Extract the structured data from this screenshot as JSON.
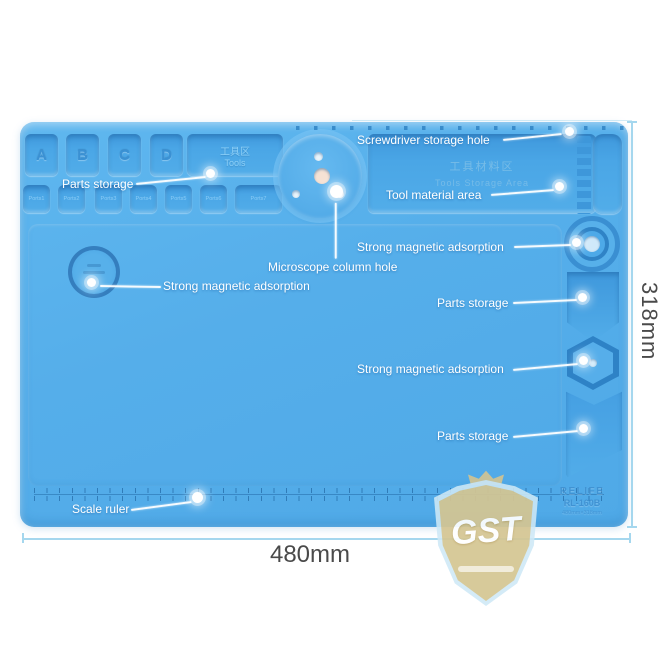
{
  "product": {
    "brand_line1": "RELIFE",
    "brand_line2": "RL-160B",
    "brand_line3": "480mm×318mm",
    "width_dim": "480mm",
    "height_dim": "318mm"
  },
  "mat": {
    "letters": [
      "A",
      "B",
      "C",
      "D"
    ],
    "tools_box_cn": "工具区",
    "tools_box_en": "Tools",
    "tool_area_cn": "工具材料区",
    "tool_area_en": "Tools Storage Area",
    "ports": [
      "Ports1",
      "Ports2",
      "Ports3",
      "Ports4",
      "Ports5",
      "Ports6",
      "Ports7"
    ]
  },
  "callouts": {
    "screwdriver_hole": "Screwdriver storage hole",
    "parts_storage_top": "Parts storage",
    "tool_material_area": "Tool material area",
    "magnetic_right_top": "Strong magnetic adsorption",
    "microscope_hole": "Microscope column hole",
    "magnetic_left": "Strong magnetic adsorption",
    "parts_storage_right": "Parts storage",
    "magnetic_right_lower": "Strong magnetic adsorption",
    "parts_storage_bottom": "Parts storage",
    "scale_ruler": "Scale ruler"
  },
  "watermark": {
    "text": "GST"
  },
  "colors": {
    "mat_blue": "#55aeea",
    "compartment_blue": "#459fe2",
    "callout_white": "#ffffff",
    "dimension_line": "#a5d7ee",
    "dimension_text": "#4a4a4a",
    "watermark_tan": "#d9c88f",
    "brand_blue": "#3e8fd0"
  }
}
